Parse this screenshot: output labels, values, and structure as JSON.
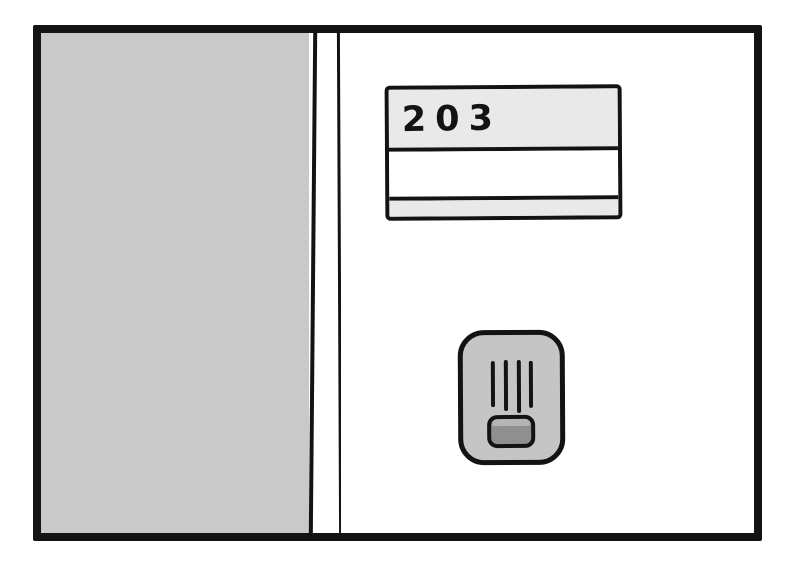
{
  "panel": {
    "kind": "hand-drawn comic panel of an apartment door",
    "outline_color": "#131313",
    "background_color": "#ffffff",
    "wall": {
      "fill": "#c9c9c9"
    },
    "door": {
      "fill": "#ffffff"
    },
    "nameplate": {
      "room_number": "203",
      "name_line_text": "",
      "band_fill": "#e9e9e9",
      "middle_fill": "#ffffff"
    },
    "intercom": {
      "body_fill": "#c5c5c5",
      "button_fill": "#8f8f8f",
      "speaker_slit_count": "4"
    }
  }
}
